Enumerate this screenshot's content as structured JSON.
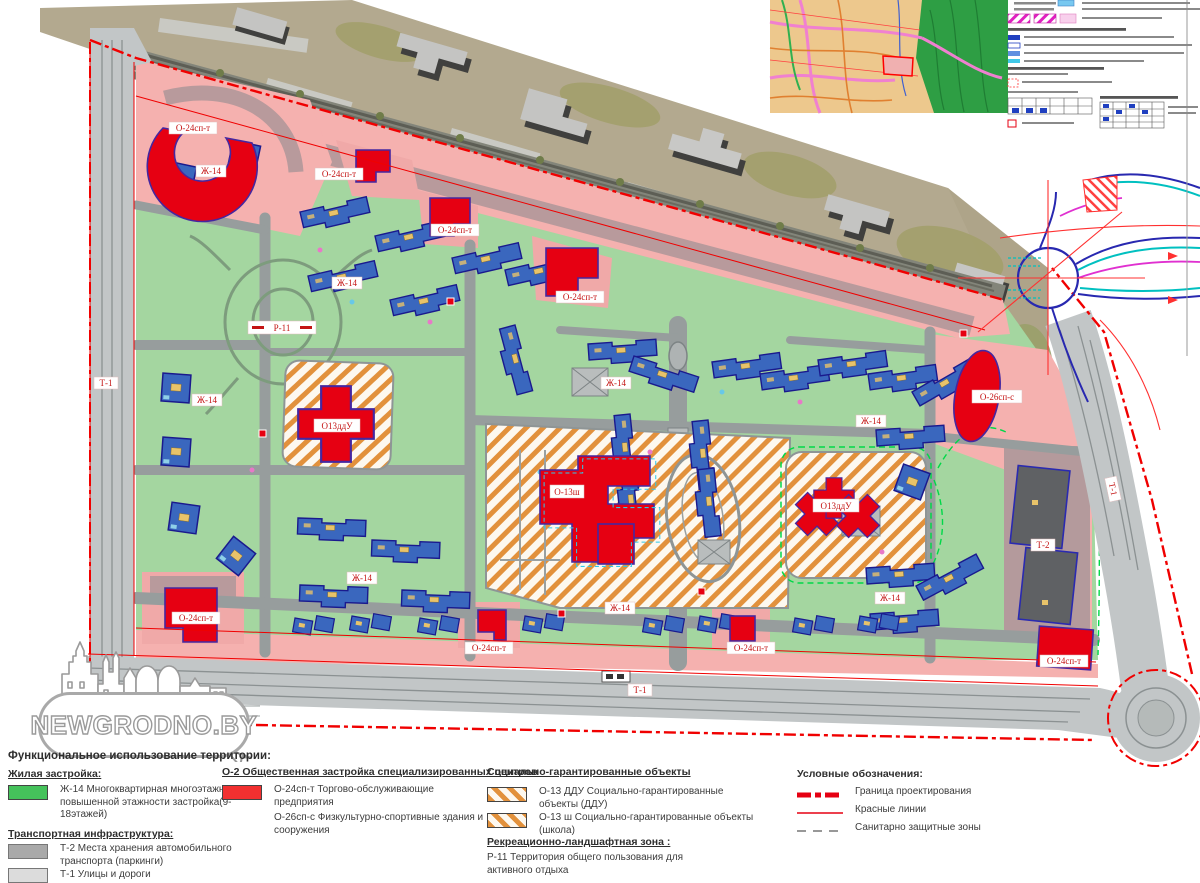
{
  "logo": {
    "text": "NEWGRODNO.BY"
  },
  "map": {
    "labels": {
      "o24": "О-24сп-т",
      "zh14": "Ж-14",
      "o13ddu": "О13ддУ",
      "o13sh": "О-13ш",
      "o26": "О-26сп-с",
      "r11": "Р-11",
      "t1": "Т-1",
      "t2": "Т-2"
    }
  },
  "legend": {
    "title": "Функциональное использование территории:",
    "residential": {
      "heading": "Жилая застройка:",
      "item1": "Ж-14  Многоквартирная  многоэтажная и повышенной этажности застройка(9-18этажей)"
    },
    "transport": {
      "heading": "Транспортная инфраструктура:",
      "item1": "Т-2 Места хранения автомобильного транспорта (паркинги)",
      "item2": "Т-1 Улицы и дороги"
    },
    "public": {
      "heading": "О-2 Общественная застройка специализированных центров",
      "item1": "О-24сп-т  Торгово-обслуживающие предприятия",
      "item2": "О-26сп-с  Физкультурно-спортивные здания и сооружения"
    },
    "social": {
      "heading": "Социально-гарантированные объекты",
      "item1": "О-13 ДДУ  Социально-гарантированные объекты (ДДУ)",
      "item2": "О-13 ш  Социально-гарантированные объекты (школа)"
    },
    "recreation": {
      "heading": "Рекреационно-ландшафтная зона :",
      "item1": "Р-11 Территория общего пользования для активного отдыха"
    },
    "symbols": {
      "heading": "Условные обозначения:",
      "item1": "Граница проектирования",
      "item2": "Красные линии",
      "item3": "Санитарно защитные зоны"
    }
  }
}
